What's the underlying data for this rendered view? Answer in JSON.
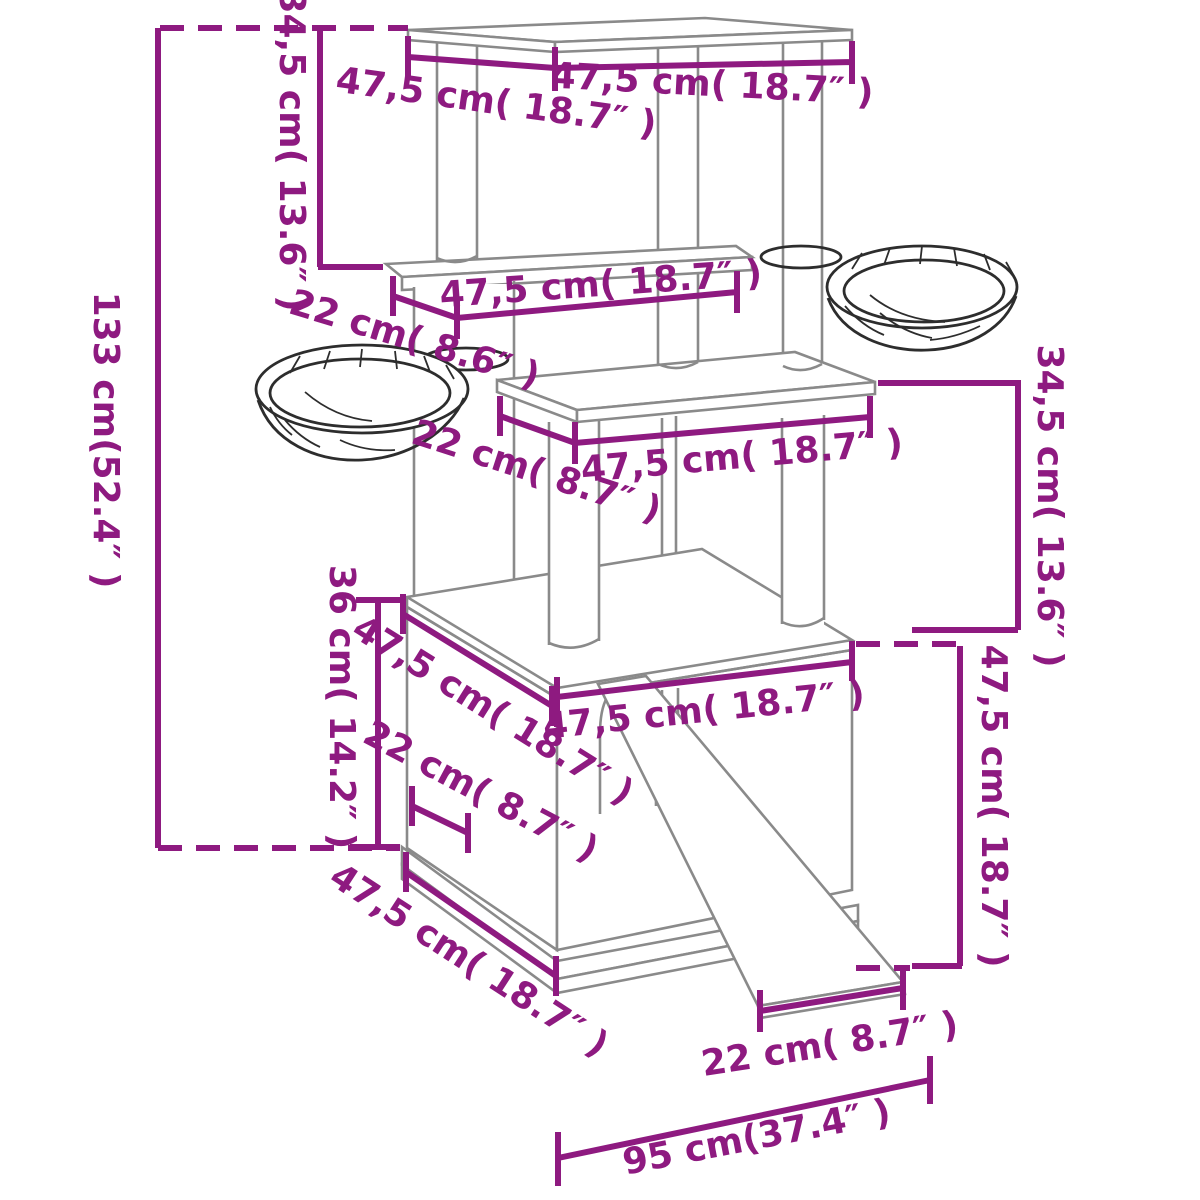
{
  "diagram": {
    "type": "product-dimensions-diagram",
    "product": "Cat tree with scratching posts, two hammock bowls, condo house and ramp",
    "units": "centimeters (inches)",
    "colors": {
      "dimension_lines": "#8e1a80",
      "structure_lines": "#8a8a8a",
      "bowl_lines": "#2d2d2d",
      "background": "#ffffff"
    },
    "dimensions": {
      "total_height": {
        "text": "133 cm(52.4″ )"
      },
      "upper_section_height_left": {
        "text": "34,5 cm( 13.6″ )"
      },
      "top_platform_width": {
        "text": "47,5 cm( 18.7″ )"
      },
      "top_platform_depth": {
        "text": "47,5 cm( 18.7″ )"
      },
      "hammock_offset": {
        "text": "22 cm( 8.6″ )"
      },
      "middle_platform_width": {
        "text": "47,5 cm( 18.7″ )"
      },
      "third_platform_offset": {
        "text": "22 cm( 8.7″ )"
      },
      "third_platform_width": {
        "text": "47,5 cm( 18.7″ )"
      },
      "middle_section_height_right": {
        "text": "34,5 cm( 13.6″ )"
      },
      "house_roof_depth": {
        "text": "47,5 cm( 18.7″ )"
      },
      "house_width": {
        "text": "47,5 cm( 18.7″ )"
      },
      "house_height": {
        "text": "36 cm( 14.2″ )"
      },
      "house_front_offset": {
        "text": "22 cm( 8.7″ )"
      },
      "ramp_section_height": {
        "text": "47,5 cm( 18.7″ )"
      },
      "base_depth_edge": {
        "text": "47,5 cm( 18.7″ )"
      },
      "ramp_bottom_width": {
        "text": "22 cm( 8.7″ )"
      },
      "total_depth": {
        "text": "95 cm(37.4″ )"
      }
    }
  }
}
